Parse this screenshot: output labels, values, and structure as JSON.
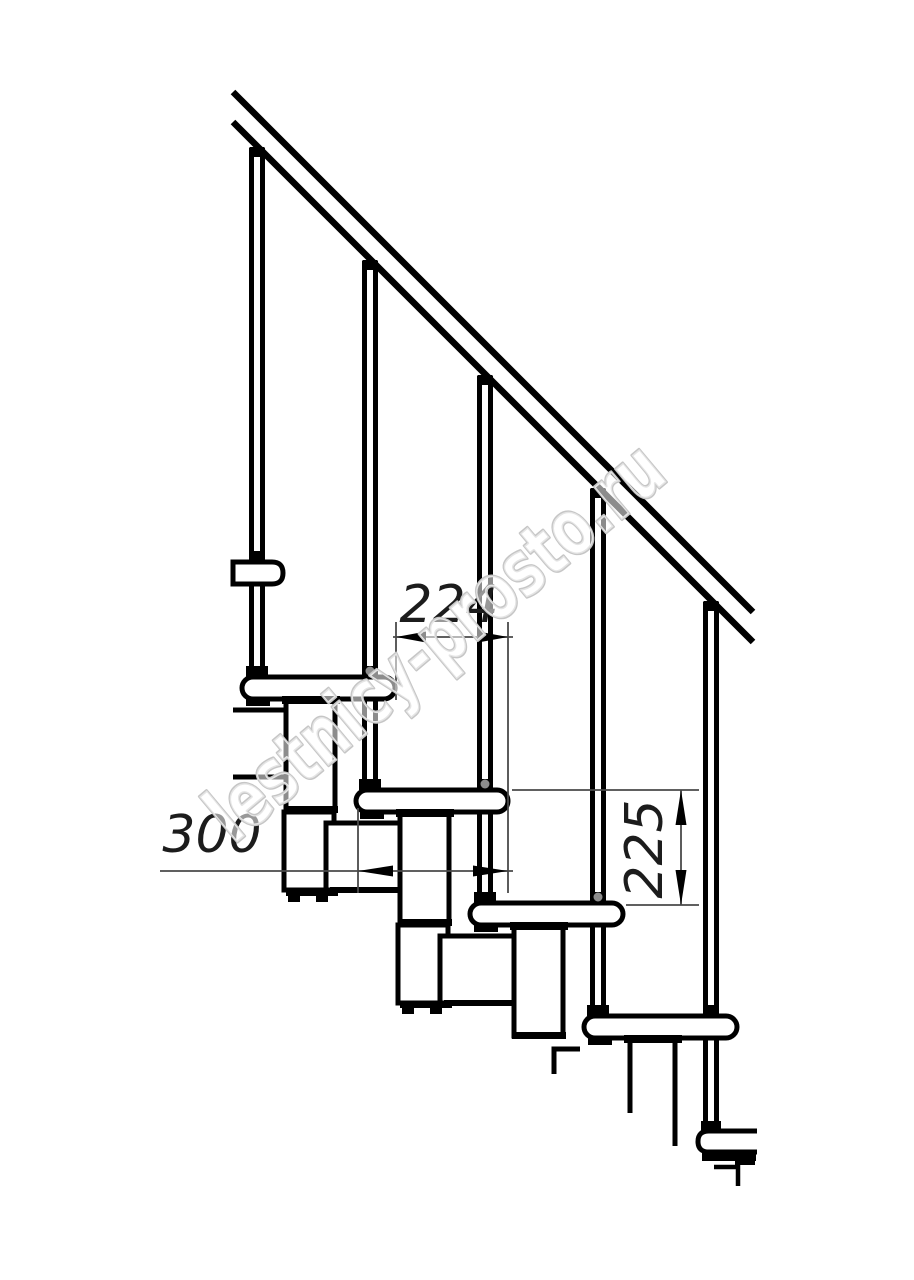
{
  "drawing": {
    "subject": "modular-staircase-side-elevation",
    "background_color": "#ffffff",
    "line_color": "#000000",
    "dim_line_color": "#4a4a4a",
    "dimensions": {
      "step_run": {
        "label": "224"
      },
      "tread_depth": {
        "label": "300"
      },
      "riser_height": {
        "label": "225"
      }
    },
    "watermark": {
      "text": "lestnicy-prosto.ru",
      "color": "#c6c6c6"
    }
  }
}
